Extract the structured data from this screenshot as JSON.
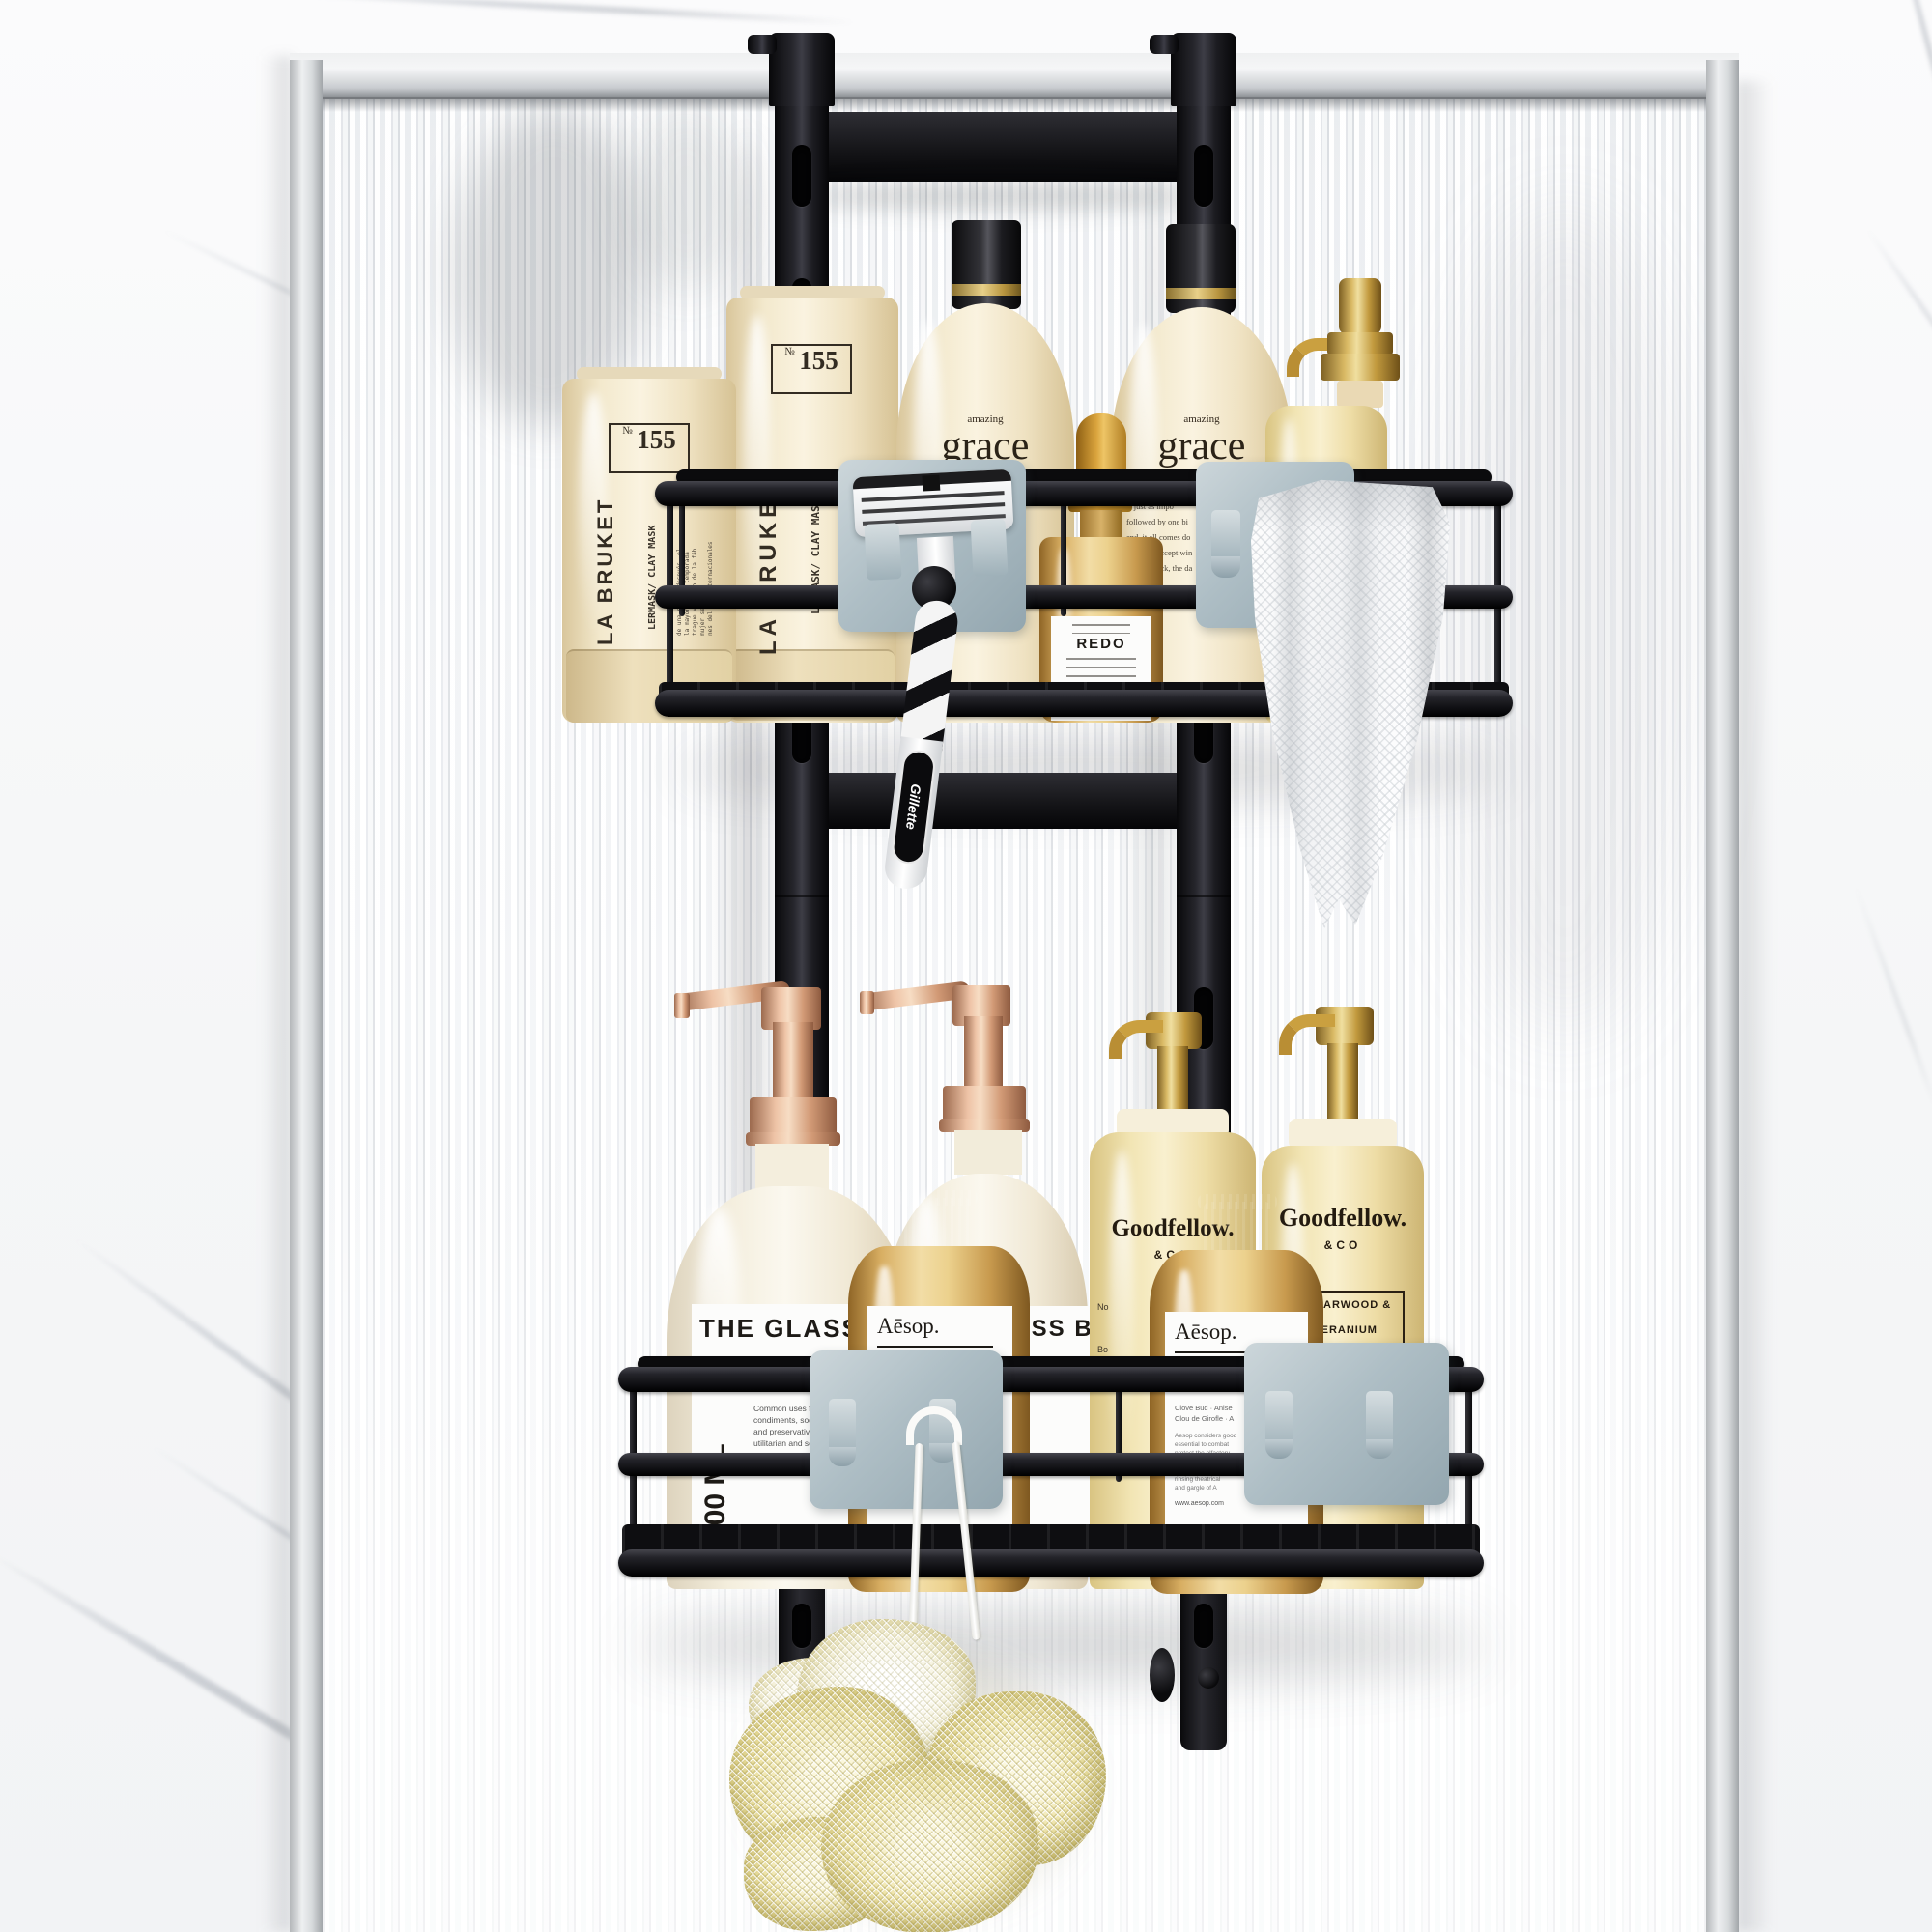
{
  "palette": {
    "marble_base": "#f6f6f7",
    "marble_vein": "#949ca8",
    "chrome_light": "#eef0f1",
    "chrome_dark": "#8f9397",
    "glass_stripe": "#dde1e5",
    "rack_black": "#16161a",
    "hook_gray": "#a7b6bd",
    "cream_bottle": "#f0e4c6",
    "amber_glass": "#d3a963",
    "gold_pump": "#c7a04c",
    "rose_gold_pump": "#dda289",
    "towel_white": "#fcfcfd",
    "loofah_yellow": "#f4eec1"
  },
  "top_shelf": {
    "tube": {
      "number_symbol": "№",
      "number": "155",
      "type": "LERMASK/ CLAY MASK",
      "brand": "LA BRUKET",
      "fine_print": "de una semana después, el\nla mayoría, la temporada\ntrague viviendo de la fáb\nmujer se hizo.\nnes del día internacionales"
    },
    "grace": {
      "name_small": "amazing",
      "name_large": "grace",
      "para_top": "how you climb up the mountain\nhow you get down. the",
      "para_main": "gigantic lesson, in\nn to one word, grace\nnning and losing, good\ndarkness and the light.",
      "perfumed": "perfumed",
      "size": "6 ml/8 fl. oz.",
      "para_philosophy": "philosophy: how you\nis just as impo\nfollowed by one bi\nend, it all comes do\nhow you accept win\nand bad luck, the da",
      "number": "236"
    },
    "dropper": {
      "heading": "REDO",
      "footer": "PARFUM D'INTERIEUR"
    },
    "gold_bottle": {
      "side_text": "ORPS"
    },
    "razor": {
      "brand": "Gillette"
    }
  },
  "bottom_shelf": {
    "glass_bottle_1": {
      "heading": "THE GLASS",
      "volume": "500 ML",
      "para": "A glass bottle is a\nGlass bottles ca\nbut are most co\n\nCommon uses for glass\ncondiments, soda, liquor\nand preservatives. These\nutilitarian and serve a",
      "footer": "9 fl oz (500mL)"
    },
    "glass_bottle_2": {
      "heading": "GLASS BOT",
      "para": "ttle is a bottle\ncan vary in\ncommonly found\n\nfor glass\nsoda, liquor\ntives. These\nserve a"
    },
    "aesop": {
      "brand": "Aēsop.",
      "product": "MOUTHWASH",
      "product_fr": "BAIN DE BOUCHE",
      "notes": "Clove Bud · Anise\nClou de Girofle · A",
      "para": "Aesop considers good\nessential to combat\nprotect the olfactory\nAnd so, to pr\nof your liquid\nrinsing theatrical\nand gargle of A",
      "url": "www.aesop.com"
    },
    "goodfellow": {
      "brand": "Goodfellow.",
      "brand_sub": "&CO",
      "scent": "CEDARWOOD &\nGERANIUM",
      "type": "Body Wash",
      "fragments": "No\n\nBo"
    }
  }
}
